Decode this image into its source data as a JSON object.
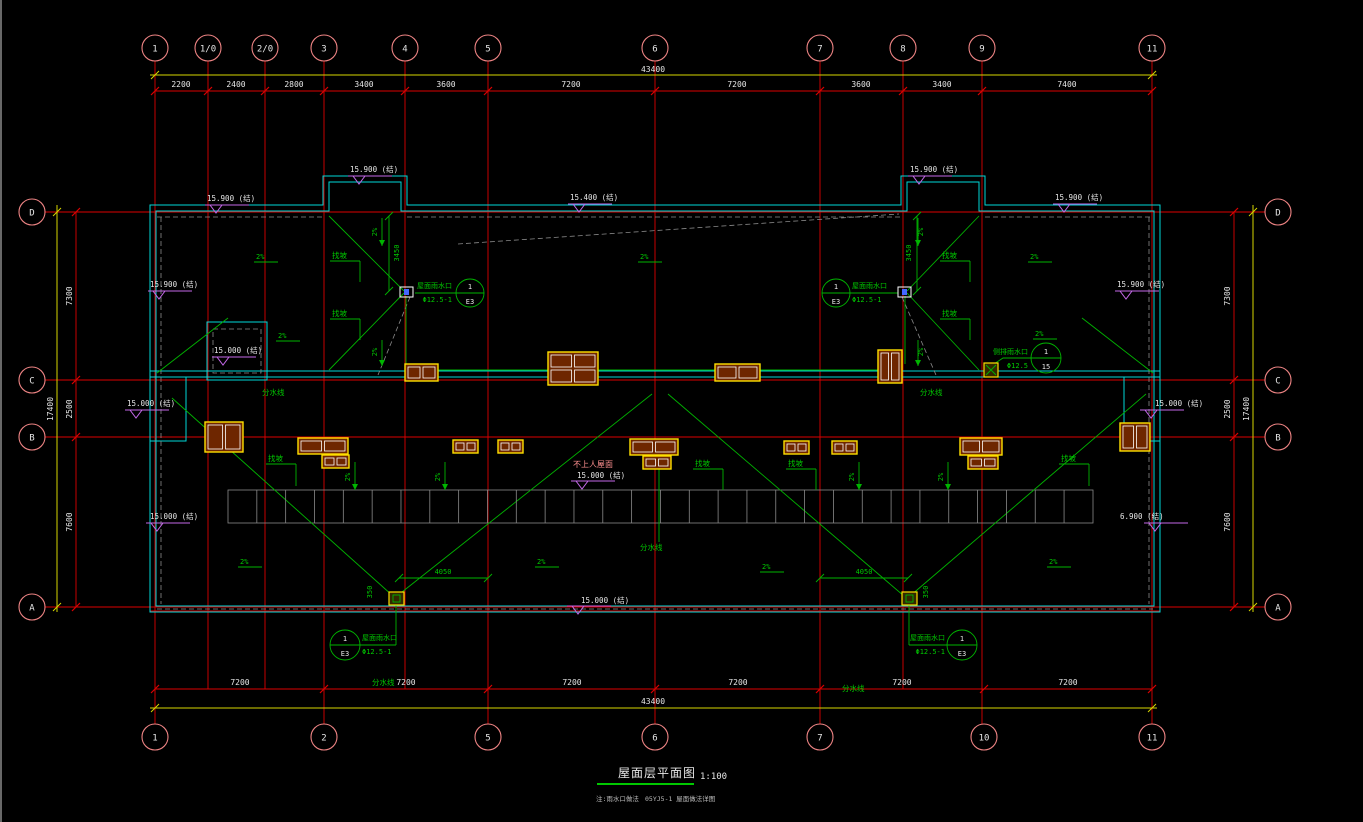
{
  "drawing": {
    "title": "屋面层平面图",
    "scale": "1:100",
    "note1": "注:雨水口做法",
    "note2": "05YJ5-1 屋面做法详图"
  },
  "axes": {
    "top": [
      "1",
      "1/0",
      "2/0",
      "3",
      "4",
      "5",
      "6",
      "7",
      "8",
      "9",
      "11"
    ],
    "bottom": [
      "1",
      "2",
      "5",
      "6",
      "7",
      "10",
      "11"
    ],
    "left": [
      "D",
      "C",
      "B",
      "A"
    ],
    "right": [
      "D",
      "C",
      "B",
      "A"
    ]
  },
  "dims": {
    "top": [
      "2200",
      "2400",
      "2800",
      "3400",
      "3600",
      "7200",
      "7200",
      "3600",
      "3400",
      "7400"
    ],
    "bottom": [
      "7200",
      "7200",
      "7200",
      "7200",
      "7200",
      "7200"
    ],
    "left": [
      "7300",
      "2500",
      "7600"
    ],
    "right": [
      "7300",
      "2500",
      "7600"
    ],
    "total_width": "43400",
    "total_height": "17400",
    "ridge_height": "3450",
    "drain_span": "4050",
    "drain_offset": "350"
  },
  "levels": {
    "main": "15.900 (结)",
    "mid": "15.400 (结)",
    "low": "15.000 (结)",
    "canopy": "6.900 (结)"
  },
  "ann": {
    "slope": "2%",
    "slope_label": "找坡",
    "valley": "分水线",
    "no_access": "不上人屋面",
    "drain": "屋面雨水口",
    "drain_spec": "Φ12.5-1",
    "side_drain": "侧排雨水口",
    "side_drain_spec": "Φ12.5",
    "callout_no": "1",
    "callout_sheet": "E3",
    "side_callout_no": "1",
    "side_callout_sheet": "15"
  }
}
